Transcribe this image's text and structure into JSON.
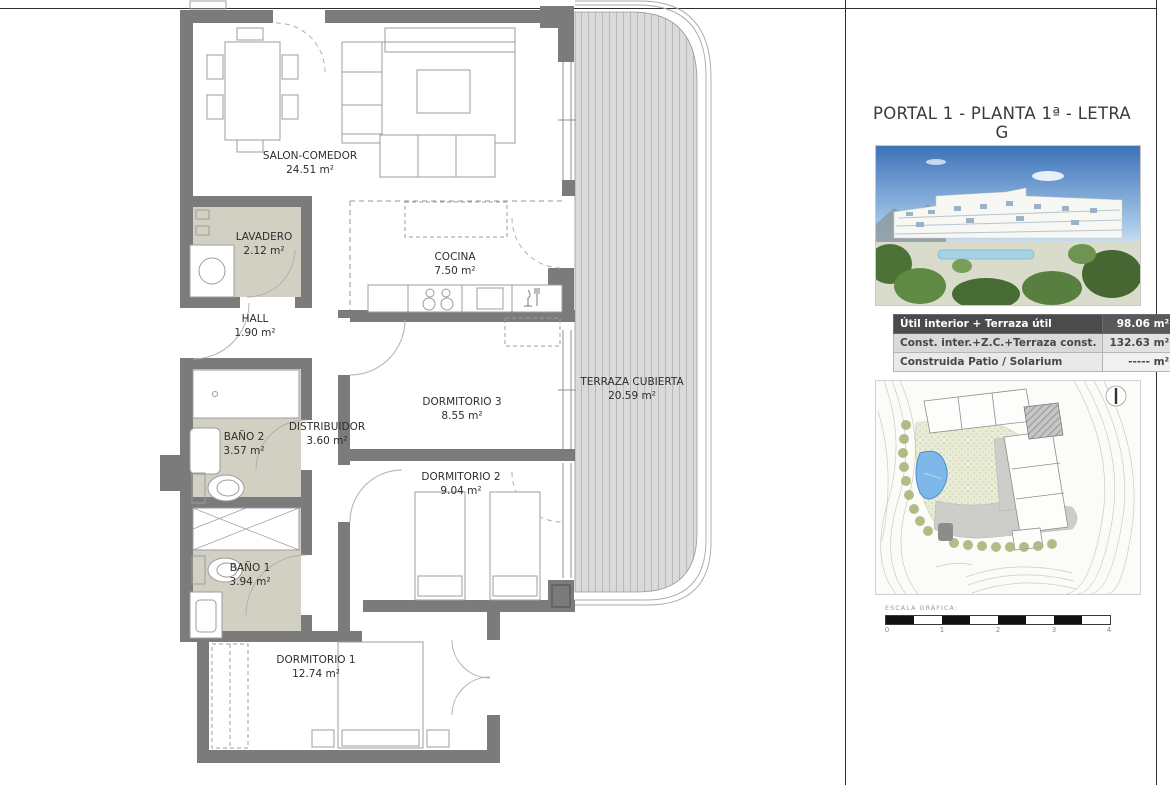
{
  "plan": {
    "rooms": [
      {
        "name": "SALON-COMEDOR",
        "area": "24.51 m²"
      },
      {
        "name": "LAVADERO",
        "area": "2.12 m²"
      },
      {
        "name": "COCINA",
        "area": "7.50 m²"
      },
      {
        "name": "HALL",
        "area": "1.90 m²"
      },
      {
        "name": "BAÑO 2",
        "area": "3.57 m²"
      },
      {
        "name": "DISTRIBUIDOR",
        "area": "3.60 m²"
      },
      {
        "name": "DORMITORIO 3",
        "area": "8.55 m²"
      },
      {
        "name": "DORMITORIO 2",
        "area": "9.04 m²"
      },
      {
        "name": "TERRAZA CUBIERTA",
        "area": "20.59 m²"
      },
      {
        "name": "BAÑO 1",
        "area": "3.94 m²"
      },
      {
        "name": "DORMITORIO 1",
        "area": "12.74 m²"
      }
    ]
  },
  "panel": {
    "title": "PORTAL 1 - PLANTA 1ª - LETRA G",
    "photo_name": "building-render",
    "areas_table": {
      "rows": [
        {
          "label": "Útil interior + Terraza útil",
          "value": "98.06 m²"
        },
        {
          "label": "Const. inter.+Z.C.+Terraza const.",
          "value": "132.63 m²"
        },
        {
          "label": "Construida Patio / Solarium",
          "value": "----- m²"
        }
      ]
    },
    "scale": {
      "label": "ESCALA GRÁFICA:",
      "ticks": [
        "0",
        "1",
        "2",
        "3",
        "4"
      ]
    }
  },
  "colors": {
    "wall": "#7b7b7b",
    "bath_floor": "#d2cfc3",
    "deck": "#dadada",
    "deck_stripe": "#bdbdbd",
    "table_header_bg": "#4b4b4d",
    "pool_blue": "#7db8e8",
    "sky_blue": "#4a7fc4"
  }
}
